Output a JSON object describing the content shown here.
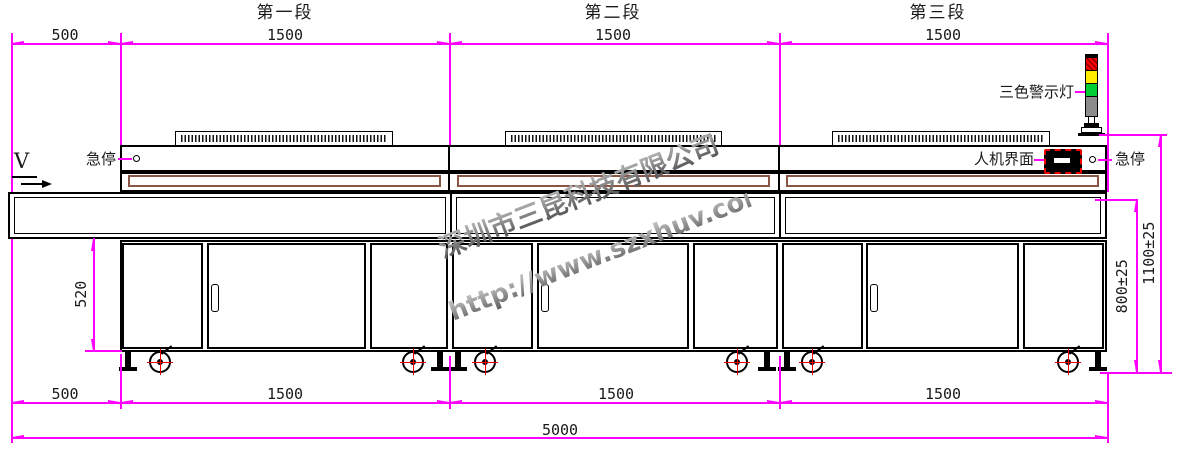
{
  "drawing": {
    "type": "machine-front-elevation",
    "machine": "three-section UV curing conveyor line"
  },
  "sections": [
    {
      "title": "第一段",
      "top_dim": "1500",
      "bottom_dim": "1500"
    },
    {
      "title": "第二段",
      "top_dim": "1500",
      "bottom_dim": "1500"
    },
    {
      "title": "第三段",
      "top_dim": "1500",
      "bottom_dim": "1500"
    }
  ],
  "dims": {
    "left_extension_top": "500",
    "left_extension_bottom": "500",
    "total_length": "5000",
    "cabinet_height": "520",
    "belt_height": "800±25",
    "overall_height": "1100±25"
  },
  "annotations": {
    "direction": "V",
    "estop_left": "急停",
    "estop_right": "急停",
    "hmi": "人机界面",
    "tower_light": "三色警示灯"
  },
  "watermark": {
    "company": "深圳市三昆科技有限公司",
    "url": "http://www.szxhuv.com"
  },
  "colors": {
    "dimension": "#ff00ff",
    "line": "#000000",
    "liner_brown": "#8b5546",
    "light_red": "#ff0000",
    "light_yellow": "#ffed00",
    "light_green": "#00cc33",
    "light_gray": "#8c8c8c",
    "watermark_gray": "#8c8c8c"
  }
}
